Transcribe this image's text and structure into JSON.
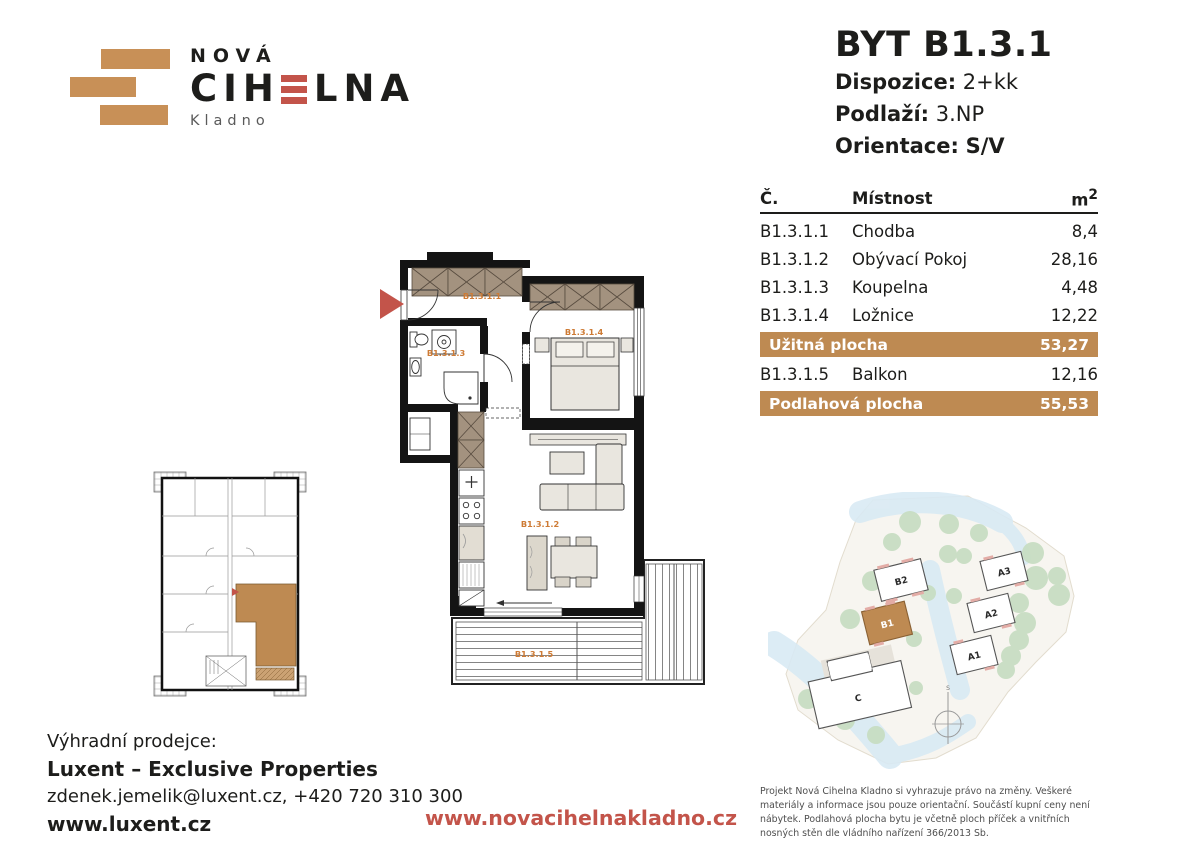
{
  "brand": {
    "top": "NOVÁ",
    "main_left": "CIH",
    "main_right": "LNA",
    "city": "Kladno"
  },
  "unit": {
    "title": "BYT B1.3.1",
    "dispozice_label": "Dispozice:",
    "dispozice_value": "2+kk",
    "podlazi_label": "Podlaží:",
    "podlazi_value": "3.NP",
    "orientace_label": "Orientace:",
    "orientace_value": "S/V"
  },
  "table": {
    "col_no": "Č.",
    "col_room": "Místnost",
    "col_area": "m",
    "col_area_sup": "2",
    "rows": [
      {
        "no": "B1.3.1.1",
        "room": "Chodba",
        "area": "8,4"
      },
      {
        "no": "B1.3.1.2",
        "room": "Obývací Pokoj",
        "area": "28,16"
      },
      {
        "no": "B1.3.1.3",
        "room": "Koupelna",
        "area": "4,48"
      },
      {
        "no": "B1.3.1.4",
        "room": "Ložnice",
        "area": "12,22"
      }
    ],
    "usable_label": "Užitná plocha",
    "usable_value": "53,27",
    "balcony_row": {
      "no": "B1.3.1.5",
      "room": "Balkon",
      "area": "12,16"
    },
    "total_label": "Podlahová plocha",
    "total_value": "55,53"
  },
  "floorplan": {
    "hall": "B1.3.1.1",
    "living": "B1.3.1.2",
    "bath": "B1.3.1.3",
    "bedroom": "B1.3.1.4",
    "balcony": "B1.3.1.5"
  },
  "sitemap": {
    "b1": "B1",
    "b2": "B2",
    "a1": "A1",
    "a2": "A2",
    "a3": "A3",
    "c": "C",
    "north": "S"
  },
  "footer": {
    "seller_intro": "Výhradní prodejce:",
    "seller_name": "Luxent – Exclusive Properties",
    "seller_contact": "zdenek.jemelik@luxent.cz, +420 720 310 300",
    "seller_web": "www.luxent.cz",
    "project_web": "www.novacihelnakladno.cz",
    "disclaimer": "Projekt Nová Cihelna Kladno si vyhrazuje právo na změny. Veškeré materiály a informace jsou pouze orientační. Součástí kupní ceny není nábytek. Podlahová plocha bytu je včetně ploch příček a vnitřních nosných stěn dle vládního nařízení 366/2013 Sb."
  },
  "colors": {
    "tan": "#BE8A52",
    "red": "#C3544A",
    "room_label": "#CE7B35"
  }
}
